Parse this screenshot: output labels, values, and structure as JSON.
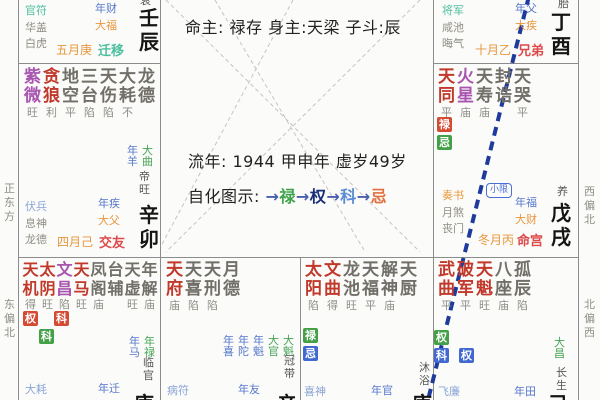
{
  "center": {
    "line1": "命主: 禄存 身主:天梁 子斗:辰",
    "line2": "流年: 1944 甲申年  虚岁49岁",
    "legend_label": "自化图示: ",
    "arrow": "→",
    "flow": [
      {
        "t": "禄",
        "color": "#3fa34d"
      },
      {
        "t": "权",
        "color": "#1a2f7a"
      },
      {
        "t": "科",
        "color": "#5b8bd4"
      },
      {
        "t": "忌",
        "color": "#e07040"
      }
    ]
  },
  "margins": {
    "left_top": "正东方",
    "left_bottom": "东偏北",
    "right_top": "西偏北",
    "right_bottom": "北偏西"
  },
  "lines": {
    "gray_dashed_color": "#c4c4c0",
    "blue_dashed_color": "#1d3a9c"
  },
  "palaces": {
    "p1": {
      "stage": "衰",
      "gods": [
        {
          "t": "官符",
          "cls": "teal"
        },
        {
          "t": "华盖",
          "cls": "grayg"
        },
        {
          "t": "白虎",
          "cls": "grayg"
        }
      ],
      "flows": [
        {
          "t": "年财",
          "cls": "blue"
        },
        {
          "t": "大福",
          "cls": "orange"
        }
      ],
      "month": "五月庚",
      "pname": "迁移",
      "ganzhi": "壬辰"
    },
    "p2": {
      "stars": [
        {
          "n": "紫微",
          "b": "旺",
          "cls": "purple"
        },
        {
          "n": "贪狼",
          "b": "利",
          "cls": "red"
        },
        {
          "n": "地空",
          "b": "平",
          "cls": "gray"
        },
        {
          "n": "三台",
          "b": "陷",
          "cls": "gray"
        },
        {
          "n": "天伤",
          "b": "陷",
          "cls": "gray"
        },
        {
          "n": "大耗",
          "b": "不",
          "cls": "gray"
        },
        {
          "n": "龙德",
          "b": "",
          "cls": "gray"
        }
      ],
      "pairs": [
        {
          "t": "年羊",
          "cls": "blue"
        },
        {
          "t": "大曲",
          "cls": "green"
        }
      ],
      "stage": "帝旺",
      "gods": [
        {
          "t": "伏兵",
          "cls": "lblue"
        },
        {
          "t": "息神",
          "cls": "grayg"
        },
        {
          "t": "龙德",
          "cls": "grayg"
        }
      ],
      "flows": [
        {
          "t": "年疾",
          "cls": "blue"
        },
        {
          "t": "大父",
          "cls": "orange"
        }
      ],
      "month": "四月己",
      "pname": "交友",
      "ganzhi": "辛卯"
    },
    "p3": {
      "stage": "胎",
      "gods": [
        {
          "t": "将军",
          "cls": "teal"
        },
        {
          "t": "咸池",
          "cls": "grayg"
        },
        {
          "t": "晦气",
          "cls": "grayg"
        }
      ],
      "flows": [
        {
          "t": "年父",
          "cls": "blue"
        },
        {
          "t": "大疾",
          "cls": "orange"
        }
      ],
      "month": "十月乙",
      "pname": "兄弟",
      "ganzhi": "丁酉"
    },
    "p4": {
      "stars": [
        {
          "n": "天同",
          "b": "平",
          "cls": "red"
        },
        {
          "n": "火星",
          "b": "庙",
          "cls": "purple"
        },
        {
          "n": "天寿",
          "b": "庙",
          "cls": "gray"
        },
        {
          "n": "封诰",
          "b": "",
          "cls": "gray"
        },
        {
          "n": "天哭",
          "b": "平",
          "cls": "gray"
        }
      ],
      "badges": [
        [
          {
            "t": "禄",
            "cls": "bred"
          }
        ],
        [
          {
            "t": "忌",
            "cls": "bgreen"
          }
        ]
      ],
      "xiaoxian": "小限",
      "stage": "养",
      "gods": [
        {
          "t": "奏书",
          "cls": "orange"
        },
        {
          "t": "月煞",
          "cls": "grayg"
        },
        {
          "t": "丧门",
          "cls": "grayg"
        }
      ],
      "flows": [
        {
          "t": "年福",
          "cls": "blue"
        },
        {
          "t": "大财",
          "cls": "orange"
        }
      ],
      "month": "冬月丙",
      "pname": "命宫",
      "ganzhi": "戊戌"
    },
    "p5": {
      "stars": [
        {
          "n": "天机",
          "b": "得",
          "cls": "red"
        },
        {
          "n": "太阴",
          "b": "旺",
          "cls": "red"
        },
        {
          "n": "文昌",
          "b": "陷",
          "cls": "purple"
        },
        {
          "n": "天马",
          "b": "旺",
          "cls": "red"
        },
        {
          "n": "凤阁",
          "b": "庙",
          "cls": "gray"
        },
        {
          "n": "台辅",
          "b": "",
          "cls": "gray"
        },
        {
          "n": "天虚",
          "b": "旺",
          "cls": "gray"
        },
        {
          "n": "年解",
          "b": "庙",
          "cls": "gray"
        }
      ],
      "badges": [
        [
          {
            "t": "权",
            "cls": "bred"
          },
          {
            "t": "科",
            "cls": "bred",
            "ml": 16
          }
        ],
        [
          {
            "t": "科",
            "cls": "bgreen",
            "ml": 16
          }
        ]
      ],
      "pairs": [
        {
          "t": "年马",
          "cls": "blue"
        },
        {
          "t": "年禄",
          "cls": "green"
        }
      ],
      "stage": "临官",
      "god_bottom": "大耗",
      "flow_bottom": "年迁",
      "stem_cut": "庚"
    },
    "p6": {
      "stars": [
        {
          "n": "天府",
          "b": "庙",
          "cls": "red"
        },
        {
          "n": "天喜",
          "b": "陷",
          "cls": "gray"
        },
        {
          "n": "天刑",
          "b": "陷",
          "cls": "gray"
        },
        {
          "n": "月德",
          "b": "",
          "cls": "gray"
        }
      ],
      "pairs": [
        {
          "t": "年喜",
          "cls": "blue"
        },
        {
          "t": "年陀",
          "cls": "blue"
        },
        {
          "t": "年魁",
          "cls": "blue"
        },
        {
          "t": "大官",
          "cls": "green"
        },
        {
          "t": "大魁",
          "cls": "green"
        }
      ],
      "stage": "冠带",
      "god_bottom": "病符",
      "flow_bottom": "年友",
      "stem_cut": "辛"
    },
    "p7": {
      "stars": [
        {
          "n": "太阳",
          "b": "陷",
          "cls": "red"
        },
        {
          "n": "文曲",
          "b": "得",
          "cls": "red"
        },
        {
          "n": "龙池",
          "b": "旺",
          "cls": "gray"
        },
        {
          "n": "天福",
          "b": "平",
          "cls": "gray"
        },
        {
          "n": "解神",
          "b": "庙",
          "cls": "gray"
        },
        {
          "n": "天厨",
          "b": "",
          "cls": "gray"
        }
      ],
      "badges": [
        [
          {
            "t": "禄",
            "cls": "bgreen"
          }
        ],
        [
          {
            "t": "忌",
            "cls": "bblue"
          }
        ]
      ],
      "stage": "沐浴",
      "god_bottom": "喜神",
      "flow_bottom": "年官",
      "stem_cut": "庚"
    },
    "p8": {
      "stars": [
        {
          "n": "武曲",
          "b": "平",
          "cls": "red"
        },
        {
          "n": "破军",
          "b": "平",
          "cls": "red"
        },
        {
          "n": "天魁",
          "b": "旺",
          "cls": "red"
        },
        {
          "n": "八座",
          "b": "庙",
          "cls": "gray"
        },
        {
          "n": "孤辰",
          "b": "陷",
          "cls": "gray"
        }
      ],
      "badges": [
        [
          {
            "t": "权",
            "cls": "bgreen"
          }
        ],
        [
          {
            "t": "科",
            "cls": "bblue"
          },
          {
            "t": "权",
            "cls": "bblue",
            "ml": 10
          }
        ]
      ],
      "pairs": [
        {
          "t": "大昌",
          "cls": "green"
        }
      ],
      "stage": "长生",
      "god_bottom": "飞廉",
      "flow_bottom": "年田",
      "stem_cut": "己"
    }
  }
}
